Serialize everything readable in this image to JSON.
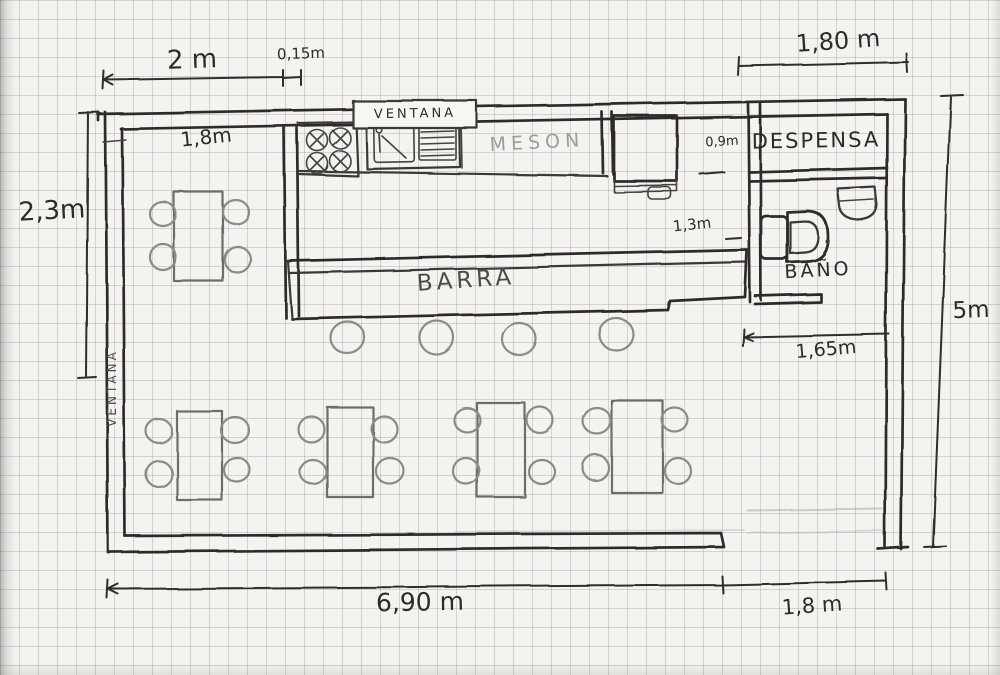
{
  "plan": {
    "labels": {
      "ventana_top": "VENTANA",
      "ventana_left": "VENTANA",
      "meson": "MESON",
      "despensa": "DESPENSA",
      "barra": "BARRA",
      "bano": "BAÑO"
    },
    "dimensions": {
      "top_width": "2 m",
      "wall_thickness": "0,15m",
      "despensa_width": "1,80 m",
      "left_height": "2,3m",
      "kitchen_inner_width": "1,8m",
      "fridge_gap": "0,9m",
      "corridor": "1,3m",
      "bath_corridor": "1,65m",
      "right_height": "5m",
      "bottom_main": "6,90 m",
      "bottom_entrance": "1,8 m"
    }
  }
}
